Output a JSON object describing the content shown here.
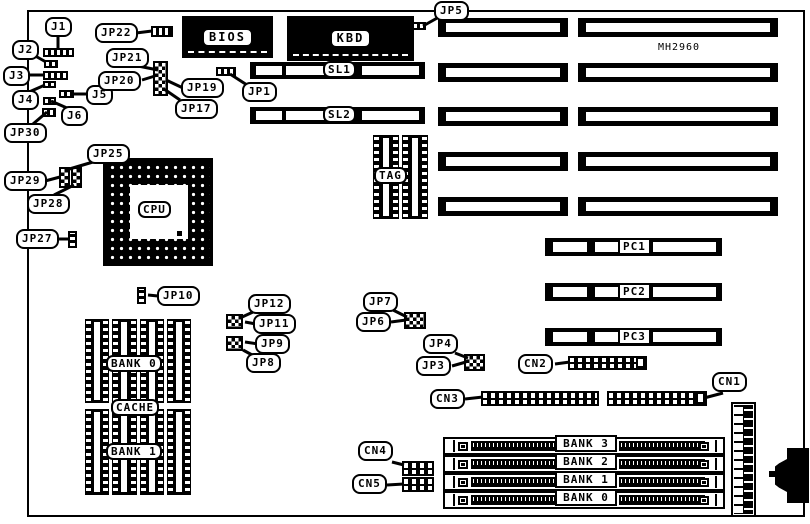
{
  "board": {
    "model": "MH2960"
  },
  "chips": {
    "bios": "BIOS",
    "kbd": "KBD",
    "cpu": "CPU",
    "tag": "TAG"
  },
  "slots": {
    "sl1": "SL1",
    "sl2": "SL2",
    "pc1": "PC1",
    "pc2": "PC2",
    "pc3": "PC3"
  },
  "memory": {
    "bank0": "BANK 0",
    "cache": "CACHE",
    "bank1": "BANK 1",
    "simm": [
      "BANK 3",
      "BANK 2",
      "BANK 1",
      "BANK 0"
    ]
  },
  "connectors": {
    "cn1": "CN1",
    "cn2": "CN2",
    "cn3": "CN3",
    "cn4": "CN4",
    "cn5": "CN5"
  },
  "jumpers": {
    "j1": "J1",
    "j2": "J2",
    "j3": "J3",
    "j4": "J4",
    "j5": "J5",
    "j6": "J6",
    "jp1": "JP1",
    "jp3": "JP3",
    "jp4": "JP4",
    "jp5": "JP5",
    "jp6": "JP6",
    "jp7": "JP7",
    "jp8": "JP8",
    "jp9": "JP9",
    "jp10": "JP10",
    "jp11": "JP11",
    "jp12": "JP12",
    "jp17": "JP17",
    "jp19": "JP19",
    "jp20": "JP20",
    "jp21": "JP21",
    "jp22": "JP22",
    "jp25": "JP25",
    "jp27": "JP27",
    "jp28": "JP28",
    "jp29": "JP29",
    "jp30": "JP30"
  }
}
